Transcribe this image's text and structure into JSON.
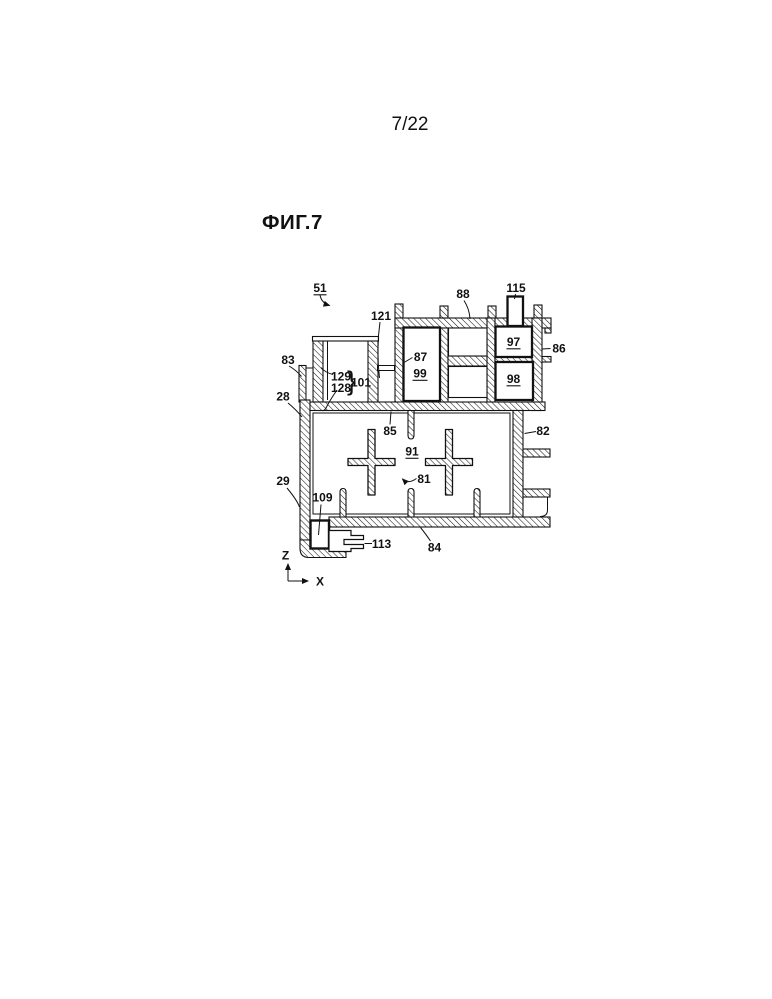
{
  "page": {
    "number": "7/22"
  },
  "figure": {
    "title": "ФИГ.7"
  },
  "axes": {
    "vertical": "Z",
    "horizontal": "X"
  },
  "reference_numerals": {
    "r51": "51",
    "r121": "121",
    "r88": "88",
    "r115": "115",
    "r86": "86",
    "r83": "83",
    "r87": "87",
    "r99": "99",
    "r97": "97",
    "r98": "98",
    "r129": "129",
    "r128": "128",
    "group_brace": "}",
    "r101": "101",
    "r28": "28",
    "r85": "85",
    "r82": "82",
    "r91": "91",
    "r81": "81",
    "r29": "29",
    "r109": "109",
    "r113": "113",
    "r84": "84"
  },
  "colors": {
    "line": "#111111",
    "background": "#ffffff"
  }
}
